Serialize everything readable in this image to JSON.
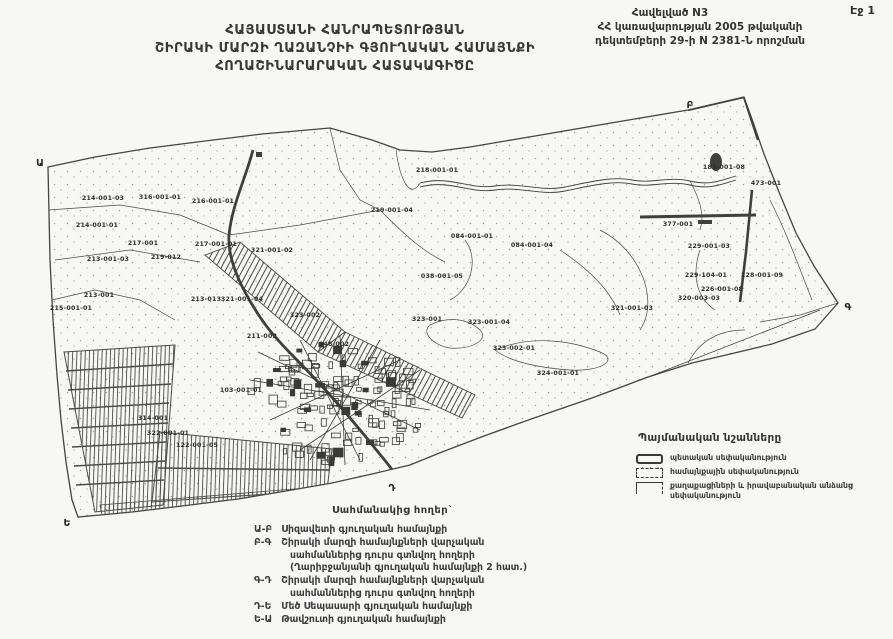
{
  "page": {
    "corner_label": "Էջ 1"
  },
  "annex": {
    "lines": [
      "Հավելված N3",
      "ՀՀ կառավարության 2005 թվականի",
      "դեկտեմբերի 29-ի N 2381-Ն որոշման"
    ]
  },
  "title": {
    "lines": [
      "ՀԱՅԱՍՏԱՆԻ ՀԱՆՐԱՊԵՏՈՒԹՅԱՆ",
      "ՇԻՐԱԿԻ ՄԱՐԶԻ ՂԱԶԱՆՉԻԻ ԳՅՈՒՂԱԿԱՆ ՀԱՄԱՅՆՔԻ",
      "ՀՈՂԱՇԻՆԱՐԱՐԱԿԱՆ ՀԱՏԱԿԱԳԻԾԸ"
    ]
  },
  "map": {
    "corner_markers": [
      {
        "label": "Ա",
        "x": 40,
        "y": 166
      },
      {
        "label": "Բ",
        "x": 690,
        "y": 108
      },
      {
        "label": "Գ",
        "x": 848,
        "y": 310
      },
      {
        "label": "Դ",
        "x": 392,
        "y": 491
      },
      {
        "label": "Ե",
        "x": 67,
        "y": 526
      }
    ],
    "parcel_labels": [
      {
        "id": "214-001-03",
        "x": 103,
        "y": 200
      },
      {
        "id": "316-001-01",
        "x": 160,
        "y": 199
      },
      {
        "id": "216-001-01",
        "x": 213,
        "y": 203
      },
      {
        "id": "214-001-01",
        "x": 97,
        "y": 227
      },
      {
        "id": "218-001-01",
        "x": 437,
        "y": 172
      },
      {
        "id": "219-001-04",
        "x": 392,
        "y": 212
      },
      {
        "id": "217-001",
        "x": 143,
        "y": 245
      },
      {
        "id": "217-001-01",
        "x": 216,
        "y": 246
      },
      {
        "id": "213-001-03",
        "x": 108,
        "y": 261
      },
      {
        "id": "219-012",
        "x": 166,
        "y": 259
      },
      {
        "id": "321-001-02",
        "x": 272,
        "y": 252
      },
      {
        "id": "213-001",
        "x": 99,
        "y": 297
      },
      {
        "id": "215-001-01",
        "x": 71,
        "y": 310
      },
      {
        "id": "213-013",
        "x": 206,
        "y": 301
      },
      {
        "id": "321-001-04",
        "x": 242,
        "y": 301
      },
      {
        "id": "323-002",
        "x": 305,
        "y": 317
      },
      {
        "id": "084-001-01",
        "x": 472,
        "y": 238
      },
      {
        "id": "084-001-04",
        "x": 532,
        "y": 247
      },
      {
        "id": "038-001-05",
        "x": 442,
        "y": 278
      },
      {
        "id": "377-001",
        "x": 678,
        "y": 226
      },
      {
        "id": "183-001-08",
        "x": 724,
        "y": 169
      },
      {
        "id": "473-001",
        "x": 766,
        "y": 185
      },
      {
        "id": "229-001-03",
        "x": 709,
        "y": 248
      },
      {
        "id": "229-104-01",
        "x": 706,
        "y": 277
      },
      {
        "id": "228-001-09",
        "x": 762,
        "y": 277
      },
      {
        "id": "226-001-08",
        "x": 722,
        "y": 291
      },
      {
        "id": "320-003-03",
        "x": 699,
        "y": 300
      },
      {
        "id": "321-001-03",
        "x": 632,
        "y": 310
      },
      {
        "id": "323-001",
        "x": 427,
        "y": 321
      },
      {
        "id": "323-001-04",
        "x": 489,
        "y": 324
      },
      {
        "id": "323-002-01",
        "x": 514,
        "y": 350
      },
      {
        "id": "324-001-01",
        "x": 558,
        "y": 375
      },
      {
        "id": "314-001",
        "x": 153,
        "y": 420
      },
      {
        "id": "322-001-01",
        "x": 168,
        "y": 435
      },
      {
        "id": "122-001-05",
        "x": 197,
        "y": 447
      },
      {
        "id": "103-001-01",
        "x": 241,
        "y": 392
      },
      {
        "id": "048-002",
        "x": 334,
        "y": 346
      },
      {
        "id": "211-002",
        "x": 262,
        "y": 338
      }
    ]
  },
  "legend": {
    "title": "Պայմանական նշանները",
    "items": [
      {
        "symbol": "state",
        "lines": [
          "պետական սեփականություն"
        ]
      },
      {
        "symbol": "community",
        "lines": [
          "համայնքային սեփականություն"
        ]
      },
      {
        "symbol": "private",
        "lines": [
          "քաղաքացիների և իրավաբանական անձանց",
          "սեփականություն"
        ]
      }
    ]
  },
  "adjacent": {
    "title": "Սահմանակից հողեր`",
    "rows": [
      {
        "code": "Ա-Բ",
        "lines": [
          "Սիզավետի գյուղական համայնքի"
        ]
      },
      {
        "code": "Բ-Գ",
        "lines": [
          "Շիրակի մարզի համայնքների վարչական",
          "սահմաններից  դուրս գտնվող հողերի",
          "(Ղարիբջանյանի գյուղական համայնքի 2 հատ.)"
        ]
      },
      {
        "code": "Գ-Դ",
        "lines": [
          "Շիրակի մարզի համայնքների վարչական",
          "սահմաններից  դուրս գտնվող հողերի"
        ]
      },
      {
        "code": "Դ-Ե",
        "lines": [
          "Մեծ Սեպասարի գյուղական համայնքի"
        ]
      },
      {
        "code": "Ե-Ա",
        "lines": [
          "Թավշուտի գյուղական համայնքի"
        ]
      }
    ]
  },
  "colors": {
    "ink": "#3a3a3a",
    "paper": "#f7f7f4",
    "map_line": "#4a4a4a"
  }
}
